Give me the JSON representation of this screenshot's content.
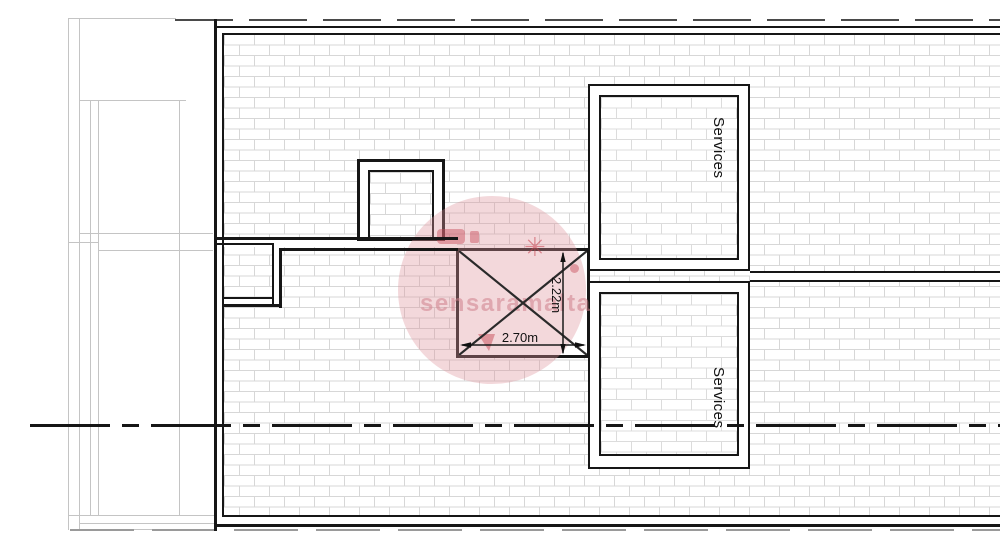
{
  "plan": {
    "rooms": [
      {
        "label": "Services"
      },
      {
        "label": "Services"
      }
    ],
    "shaft": {
      "width_label": "2.70m",
      "height_label": "2.22m"
    }
  },
  "watermark": {
    "text": "sensaramalta",
    "star": "✳"
  },
  "colors": {
    "wall": "#161616",
    "hatch_line": "#d7d7d7",
    "adjacent_outline": "#c4c4c4",
    "centerline": "#161616",
    "watermark_pink": "#de9aa2"
  }
}
